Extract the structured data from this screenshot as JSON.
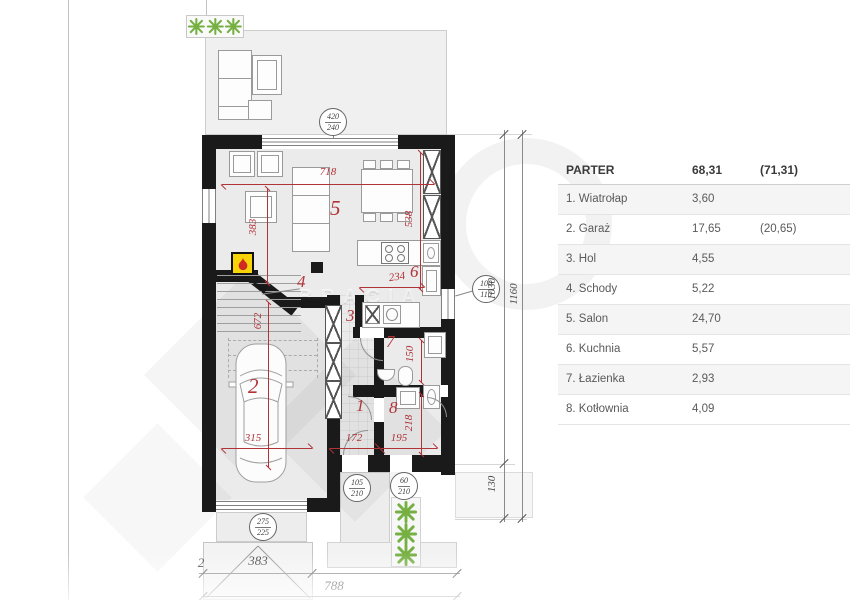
{
  "legend": {
    "title": "PARTER",
    "title_area": "68,31",
    "title_area_alt": "(71,31)",
    "rows": [
      {
        "name": "1. Wiatrołap",
        "area": "3,60",
        "area_alt": ""
      },
      {
        "name": "2. Garaż",
        "area": "17,65",
        "area_alt": "(20,65)"
      },
      {
        "name": "3. Hol",
        "area": "4,55",
        "area_alt": ""
      },
      {
        "name": "4. Schody",
        "area": "5,22",
        "area_alt": ""
      },
      {
        "name": "5. Salon",
        "area": "24,70",
        "area_alt": ""
      },
      {
        "name": "6. Kuchnia",
        "area": "5,57",
        "area_alt": ""
      },
      {
        "name": "7. Łazienka",
        "area": "2,93",
        "area_alt": ""
      },
      {
        "name": "8. Kotłownia",
        "area": "4,09",
        "area_alt": ""
      }
    ]
  },
  "plan": {
    "rooms": {
      "r1": "1",
      "r2": "2",
      "r3": "3",
      "r4": "4",
      "r5": "5",
      "r6": "6",
      "r7": "7",
      "r8": "8"
    },
    "dims": {
      "salon_width": "718",
      "salon_depth": "383",
      "salon_right": "538",
      "kitchen_width": "234",
      "garage_depth": "672",
      "garage_width": "315",
      "hall_width": "172",
      "boiler_width": "195",
      "boiler_depth": "218",
      "bath_depth": "150"
    },
    "openings": {
      "terrace_door": {
        "w": "420",
        "h": "240"
      },
      "side_window": {
        "w": "100",
        "h": "110"
      },
      "garage_door": {
        "w": "275",
        "h": "225"
      },
      "entry_door": {
        "w": "105",
        "h": "210"
      },
      "boiler_door": {
        "w": "60",
        "h": "210"
      }
    },
    "site_dims": {
      "house_depth": "1030",
      "porch_depth": "130",
      "total_depth": "1160",
      "edge": "2",
      "drive_width": "383",
      "front_width": "788"
    },
    "watermark": "BRACIA"
  },
  "colors": {
    "dim_red": "#b03338",
    "wall_black": "#1a1a1a",
    "plant_green": "#76b043",
    "fireplace_yellow": "#f7d408",
    "flame_red": "#cf2b24",
    "floor_gray": "#ebebeb"
  }
}
